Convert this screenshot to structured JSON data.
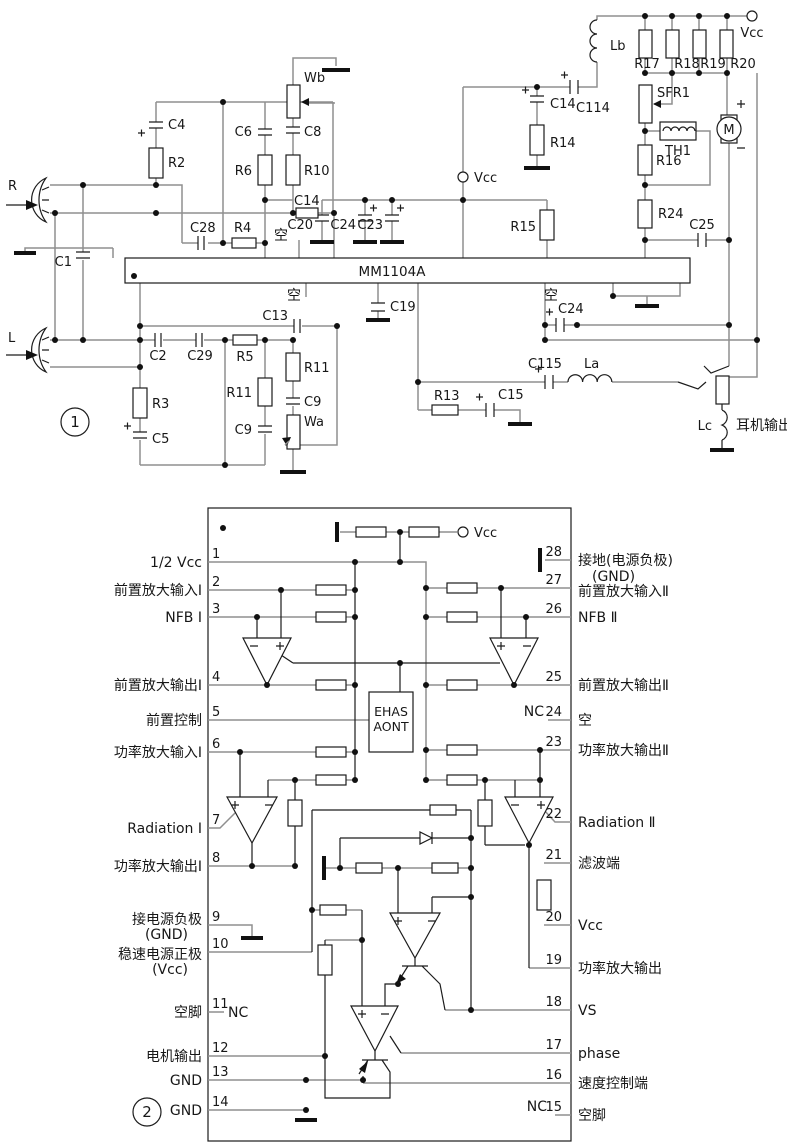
{
  "figure1": {
    "badge": "1",
    "ic": "MM1104A",
    "labels": {
      "r_input": "R",
      "l_input": "L",
      "c1": "C1",
      "c4": "C4",
      "r2": "R2",
      "wb": "Wb",
      "c6": "C6",
      "c8": "C8",
      "r6": "R6",
      "r10": "R10",
      "c14_top": "C14",
      "c28": "C28",
      "r4": "R4",
      "kong_top": "空",
      "c20": "C20",
      "c24_mid": "C24",
      "c23": "C23",
      "vcc_mid": "Vcc",
      "r15": "R15",
      "lb": "Lb",
      "c114": "C114",
      "c14_right": "C14",
      "r14": "R14",
      "r17": "R17",
      "r18": "R18",
      "r19": "R19",
      "r20": "R20",
      "vcc_top": "Vcc",
      "sfr1": "SFR1",
      "th1": "TH1",
      "r16": "R16",
      "motor": "M",
      "r24": "R24",
      "c25": "C25",
      "kong_bottom": "空",
      "c13": "C13",
      "c19": "C19",
      "c2": "C2",
      "c29": "C29",
      "r5": "R5",
      "r11_a": "R11",
      "c9_a": "C9",
      "r11_b": "R11",
      "c9_b": "C9",
      "wa": "Wa",
      "r3": "R3",
      "c5": "C5",
      "kong_right": "空",
      "c24_right": "C24",
      "r13": "R13",
      "c15": "C15",
      "c115": "C115",
      "la": "La",
      "lc": "Lc",
      "earphone_out": "耳机输出"
    }
  },
  "figure2": {
    "badge": "2",
    "vcc": "Vcc",
    "block": {
      "line1": "EHAS",
      "line2": "AONT"
    },
    "pins_left": [
      {
        "num": "1",
        "label": "1/2 Vcc"
      },
      {
        "num": "2",
        "label": "前置放大输入Ⅰ"
      },
      {
        "num": "3",
        "label": "NFB Ⅰ"
      },
      {
        "num": "4",
        "label": "前置放大输出Ⅰ"
      },
      {
        "num": "5",
        "label": "前置控制"
      },
      {
        "num": "6",
        "label": "功率放大输入Ⅰ"
      },
      {
        "num": "7",
        "label": "Radiation Ⅰ"
      },
      {
        "num": "8",
        "label": "功率放大输出Ⅰ"
      },
      {
        "num": "9",
        "label": "接电源负极",
        "sub": "(GND)"
      },
      {
        "num": "10",
        "label": "稳速电源正极",
        "sub": "(Vcc)"
      },
      {
        "num": "11",
        "label": "空脚",
        "nc": "NC"
      },
      {
        "num": "12",
        "label": "电机输出"
      },
      {
        "num": "13",
        "label": "GND"
      },
      {
        "num": "14",
        "label": "GND"
      }
    ],
    "pins_right": [
      {
        "num": "28",
        "label": "接地(电源负极)",
        "sub": "(GND)"
      },
      {
        "num": "27",
        "label": "前置放大输入Ⅱ"
      },
      {
        "num": "26",
        "label": "NFB Ⅱ"
      },
      {
        "num": "25",
        "label": "前置放大输出Ⅱ"
      },
      {
        "num": "24",
        "label": "空",
        "nc": "NC"
      },
      {
        "num": "23",
        "label": "功率放大输出Ⅱ"
      },
      {
        "num": "22",
        "label": "Radiation Ⅱ"
      },
      {
        "num": "21",
        "label": "滤波端"
      },
      {
        "num": "20",
        "label": "Vcc"
      },
      {
        "num": "19",
        "label": "功率放大输出"
      },
      {
        "num": "18",
        "label": "VS"
      },
      {
        "num": "17",
        "label": "phase"
      },
      {
        "num": "16",
        "label": "速度控制端"
      },
      {
        "num": "15",
        "label": "空脚",
        "nc": "NC"
      }
    ]
  }
}
